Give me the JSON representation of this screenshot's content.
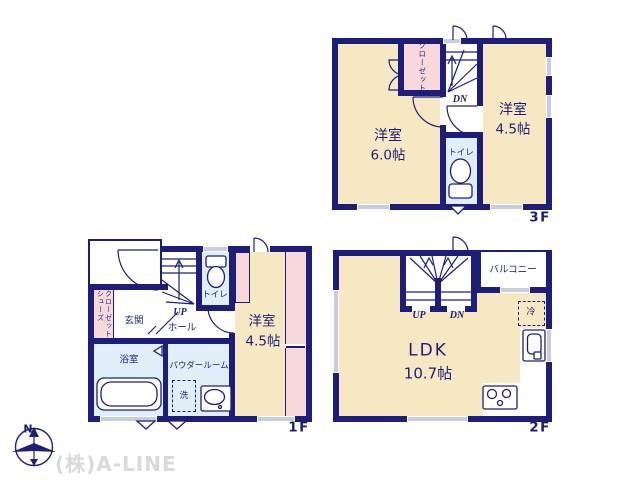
{
  "company": "(株)A-LINE",
  "compass_north": "N",
  "colors": {
    "wall": "#1e1e78",
    "room_yellow": "#f6e8c3",
    "closet_pink": "#f8d9db",
    "wet_blue": "#dfeef7",
    "window_gray": "#c9cce0",
    "watermark_gray": "#d9d9d9"
  },
  "floor3": {
    "label": "3F",
    "room_a_name": "洋室",
    "room_a_size": "6.0帖",
    "room_b_name": "洋室",
    "room_b_size": "4.5帖",
    "closet": "クローゼット",
    "toilet": "トイレ",
    "stairs_down": "DN"
  },
  "floor2": {
    "label": "2F",
    "ldk_name": "LDK",
    "ldk_size": "10.7帖",
    "balcony": "バルコニー",
    "refrigerator": "冷",
    "stairs_up": "UP",
    "stairs_down": "DN"
  },
  "floor1": {
    "label": "1F",
    "entrance": "玄関",
    "hall": "ホール",
    "shoes_closet_col1": "シューズ",
    "shoes_closet_col2": "クローゼット",
    "bathroom": "浴室",
    "powder_room": "パウダールーム",
    "laundry": "洗",
    "toilet": "トイレ",
    "room_name": "洋室",
    "room_size": "4.5帖",
    "stairs_up": "UP"
  }
}
